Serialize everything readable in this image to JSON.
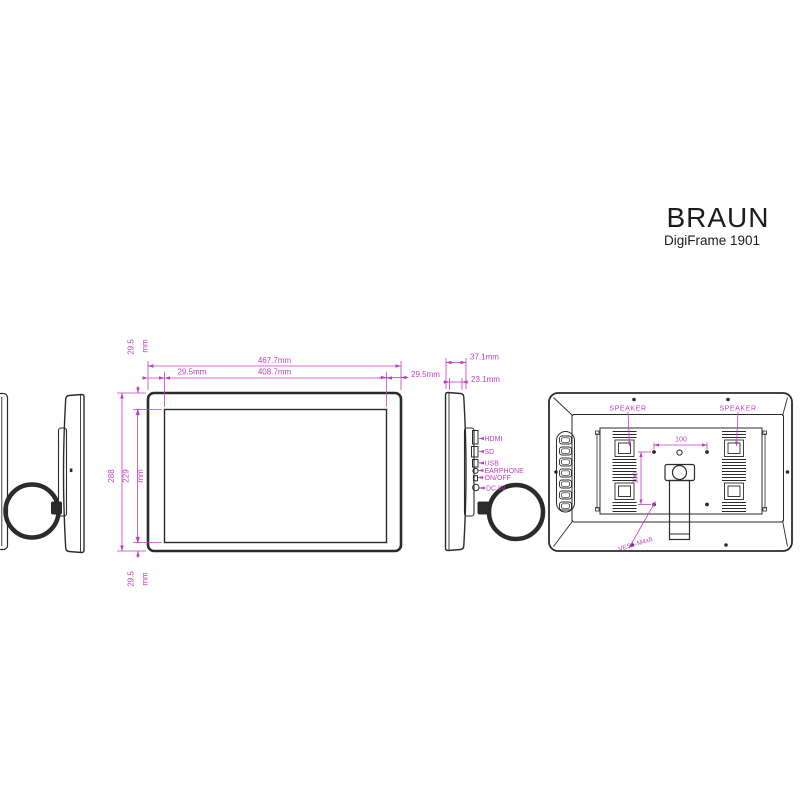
{
  "title": {
    "brand": "BRAUN",
    "model": "DigiFrame 1901"
  },
  "colors": {
    "background": "#ffffff",
    "line": "#2b2b2b",
    "dimension": "#c03fc0"
  },
  "front_view": {
    "overall_width": "467.7mm",
    "display_width": "408.7mm",
    "bezel_left": "29.5mm",
    "bezel_right": "29.5mm",
    "overall_height": "288",
    "display_height": "229",
    "display_height_unit": "mm",
    "bezel_top": "29.5",
    "bezel_top_unit": "mm",
    "bezel_bottom": "29.5",
    "bezel_bottom_unit": "mm"
  },
  "side_view": {
    "depth_overall": "37.1mm",
    "depth_body": "23.1mm",
    "ports": {
      "hdmi": "HDMI",
      "sd": "SD",
      "usb": "USB",
      "earphone": "EARPHONE",
      "power": "ON/OFF",
      "dc_in": "DC IN"
    }
  },
  "rear_view": {
    "speaker_left": "SPEAKER",
    "speaker_right": "SPEAKER",
    "vesa_width": "100",
    "vesa_height": "100",
    "vesa_note": "VESA-M4x8"
  }
}
